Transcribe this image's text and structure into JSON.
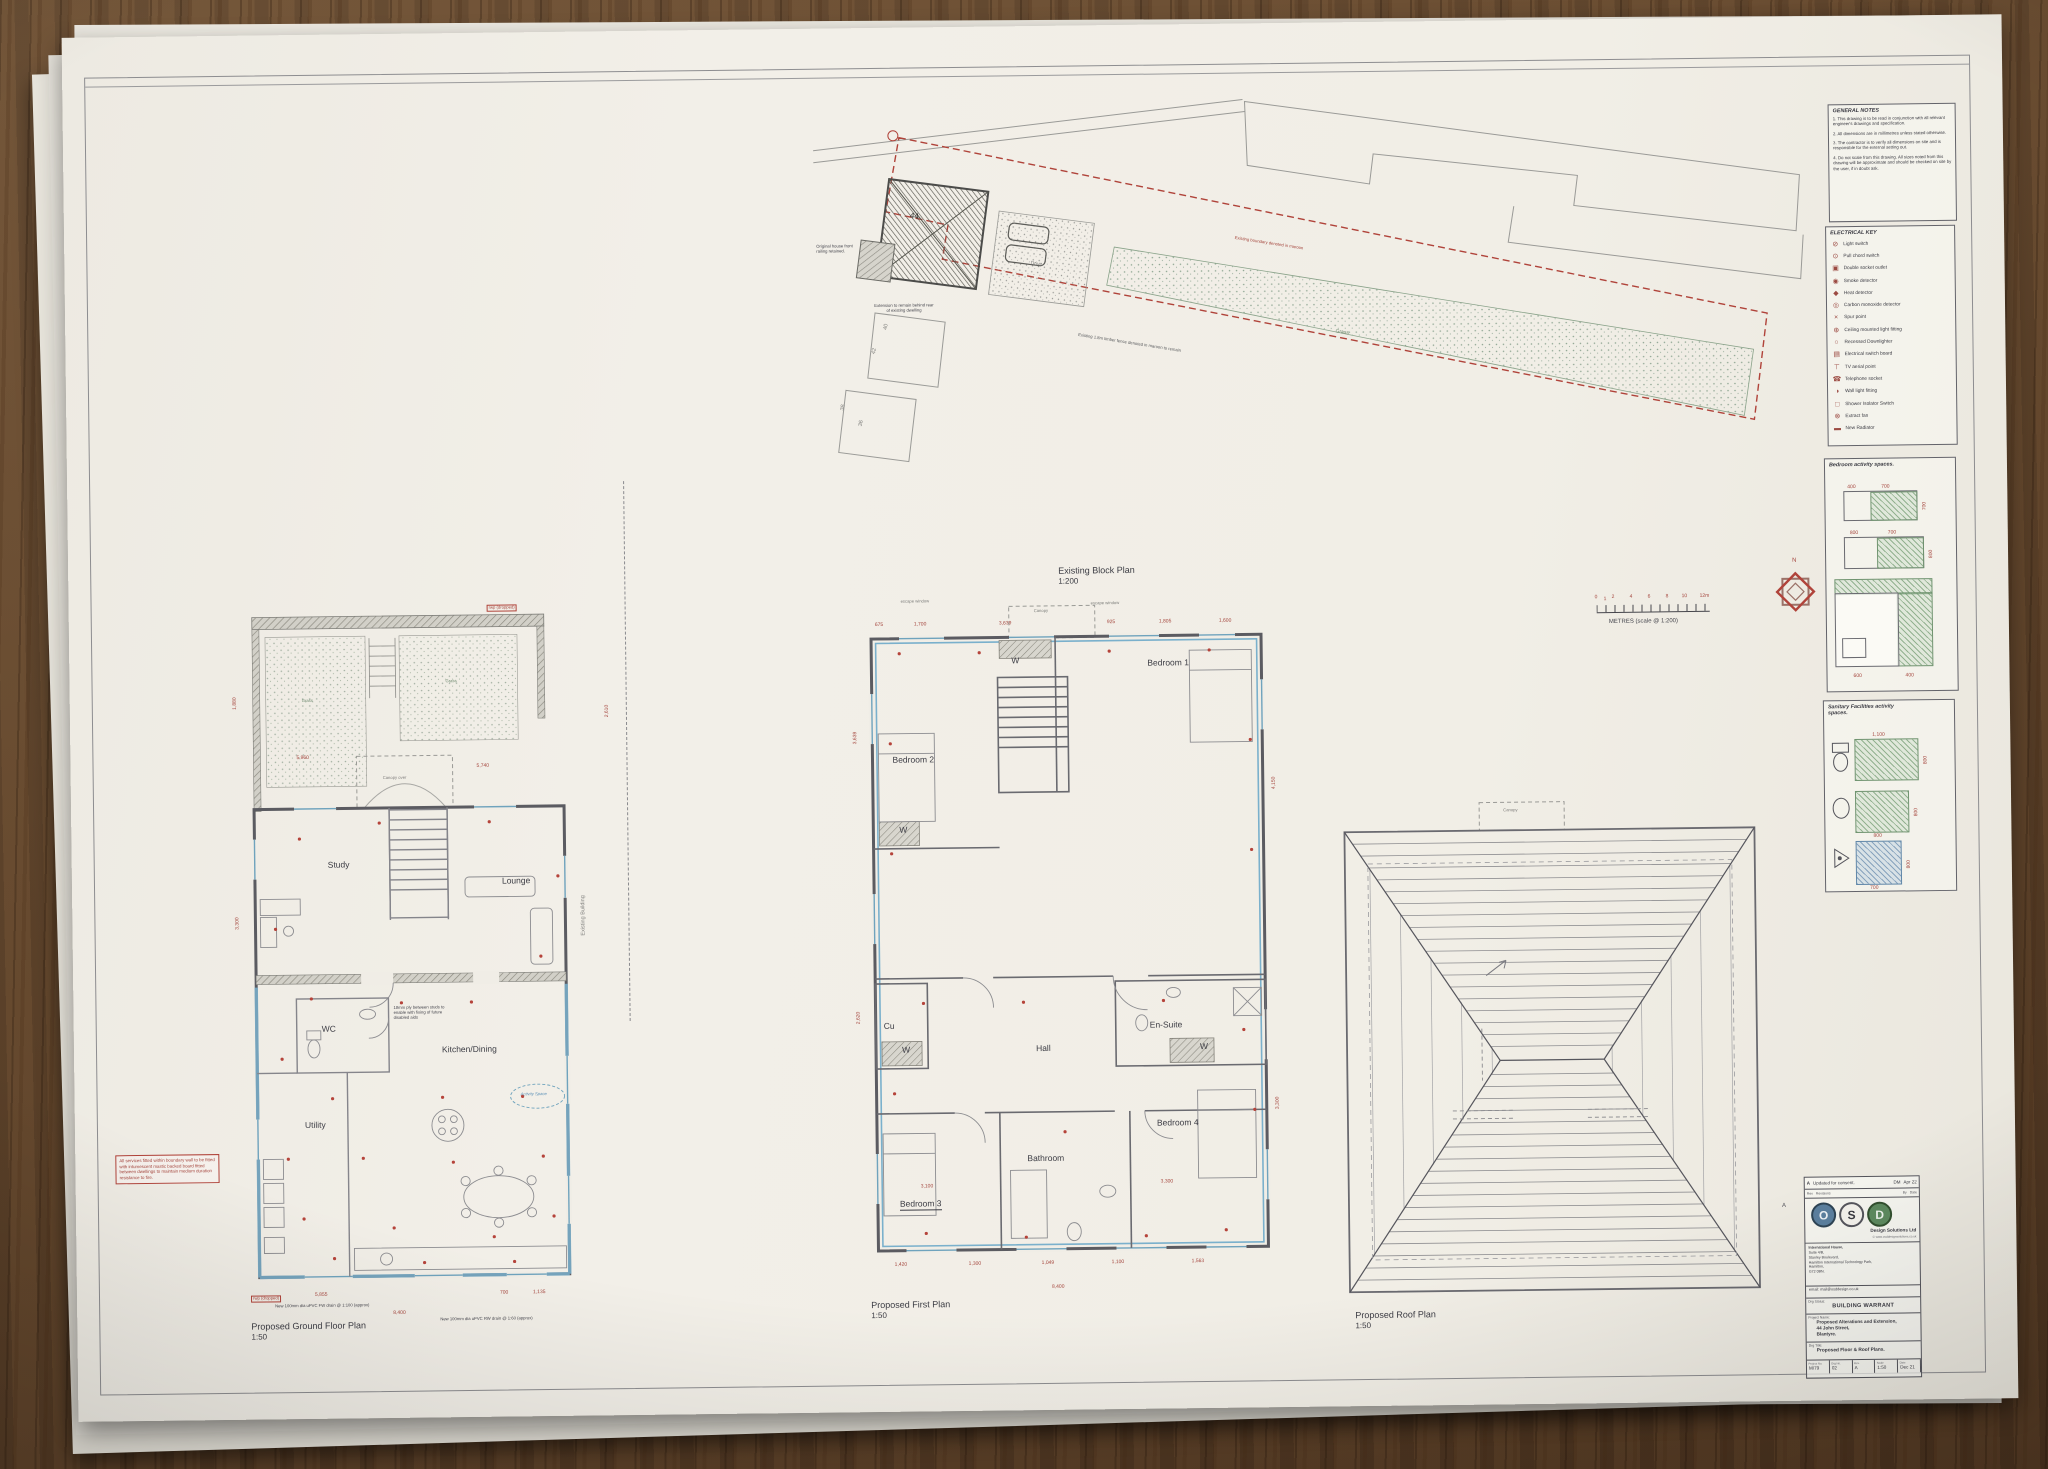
{
  "block_plan": {
    "title": "Existing Block Plan",
    "scale": "1:200",
    "house_number": "44",
    "plot_numbers": [
      "40",
      "42",
      "38",
      "36"
    ],
    "labels": {
      "drive": "Drive",
      "grass": "Grass",
      "boundary_note": "Existing boundary denoted in maroon",
      "fence_note": "Existing 1.8m timber fence denoted in maroon to remain",
      "extension_note": "Extension to remain behind rear of existing dwelling",
      "railing_note": "Original house front railing retained."
    }
  },
  "scale_bar": {
    "caption": "METRES (scale @ 1:200)",
    "north": "N",
    "tick_marks": [
      {
        "t": "0",
        "x": -2,
        "y": -11
      },
      {
        "t": "1",
        "x": 7,
        "y": -9
      },
      {
        "t": "2",
        "x": 15,
        "y": -11
      },
      {
        "t": "4",
        "x": 33,
        "y": -11
      },
      {
        "t": "6",
        "x": 51,
        "y": -11
      },
      {
        "t": "8",
        "x": 69,
        "y": -11
      },
      {
        "t": "10",
        "x": 85,
        "y": -11
      },
      {
        "t": "12m",
        "x": 103,
        "y": -11
      }
    ]
  },
  "general_notes": {
    "title": "GENERAL NOTES",
    "items": [
      "1.  This drawing is to be read in conjunction with all relevant engineer's drawings and specification.",
      "2.  All dimensions are in millimetres unless stated otherwise.",
      "3.  The contractor is to verify all dimensions on site and is responsible for the external setting out.",
      "4.  Do not scale from this drawing. All sizes noted from this drawing will be approximate and should be checked on site by the user, if in doubt ask."
    ]
  },
  "electrical_key": {
    "title": "ELECTRICAL KEY",
    "items": [
      {
        "icon": "switch",
        "glyph": "⊘",
        "label": "Light switch"
      },
      {
        "icon": "pull-chord",
        "glyph": "⊙",
        "label": "Pull chord switch"
      },
      {
        "icon": "socket",
        "glyph": "▣",
        "label": "Double socket outlet"
      },
      {
        "icon": "smoke",
        "glyph": "◉",
        "label": "Smoke detector"
      },
      {
        "icon": "heat",
        "glyph": "◆",
        "label": "Heat detector"
      },
      {
        "icon": "co",
        "glyph": "◎",
        "label": "Carbon monoxide detector"
      },
      {
        "icon": "spur",
        "glyph": "×",
        "label": "Spur point"
      },
      {
        "icon": "ceiling-light",
        "glyph": "⊕",
        "label": "Ceiling mounted light fitting"
      },
      {
        "icon": "downlight",
        "glyph": "○",
        "label": "Recessed Downlighter"
      },
      {
        "icon": "board",
        "glyph": "▤",
        "label": "Electrical switch board"
      },
      {
        "icon": "tv",
        "glyph": "⊤",
        "label": "TV aerial point"
      },
      {
        "icon": "phone",
        "glyph": "☎",
        "label": "Telephone socket"
      },
      {
        "icon": "wall-light",
        "glyph": "◑",
        "label": "Wall light fitting"
      },
      {
        "icon": "shower-switch",
        "glyph": "□",
        "label": "Shower Isolator Switch"
      },
      {
        "icon": "fan",
        "glyph": "⊗",
        "label": "Extract fan"
      },
      {
        "icon": "radiator",
        "glyph": "▬",
        "label": "New Radiator"
      }
    ]
  },
  "bedroom_spaces": {
    "title": "Bedroom activity spaces.",
    "d1": [
      "400",
      "700",
      "700"
    ],
    "d2": [
      "800",
      "700",
      "800"
    ],
    "d3": [
      "600",
      "400"
    ]
  },
  "sanitary_spaces": {
    "title": "Sanitary Facilities activity spaces.",
    "wc": [
      "1,100",
      "800"
    ],
    "basin": [
      "800",
      "800"
    ],
    "shower": [
      "800",
      "700"
    ]
  },
  "ground_floor": {
    "title": "Proposed Ground Floor Plan",
    "scale": "1:50",
    "rooms": {
      "study": "Study",
      "lounge": "Lounge",
      "wc": "WC",
      "kitchen": "Kitchen/Dining",
      "utility": "Utility"
    },
    "labels": {
      "grass_left": "Grass",
      "grass_right": "Grass",
      "canopy": "Canopy over",
      "activity": "Activity Space",
      "ply_note": "18mm ply between studs to enable with fixing of future disabled aids",
      "existing_building": "Existing Building",
      "rwp1": "rwp (dropped)",
      "rwp2": "rwp (dropped)"
    },
    "red_note": "All services fitted within boundary wall to be fitted with intumescent mastic backed board fitted between dwellings to maintain medium duration resistance to fire.",
    "drain_note_fw": "New 100mm dia uPVC FW drain @ 1:100 (approx)",
    "drain_note_rw": "New 100mm dia uPVC RW drain @ 1:60 (approx)",
    "dims": [
      {
        "t": "5,960",
        "x": 58,
        "y": 296
      },
      {
        "t": "5,740",
        "x": 238,
        "y": 306
      },
      {
        "t": "1,880",
        "x": -6,
        "y": 250,
        "r": -90
      },
      {
        "t": "3,300",
        "x": -6,
        "y": 470,
        "r": -90
      },
      {
        "t": "2,610",
        "x": 366,
        "y": 262,
        "r": -90
      },
      {
        "t": "8,400",
        "x": 148,
        "y": 852
      },
      {
        "t": "5,855",
        "x": 70,
        "y": 833
      },
      {
        "t": "700",
        "x": 255,
        "y": 833
      },
      {
        "t": "1,135",
        "x": 288,
        "y": 833
      }
    ]
  },
  "first_floor": {
    "title": "Proposed First Plan",
    "scale": "1:50",
    "rooms": {
      "bedroom1": "Bedroom 1",
      "bedroom2": "Bedroom 2",
      "bedroom3": "Bedroom 3",
      "bedroom4": "Bedroom 4",
      "bathroom": "Bathroom",
      "ensuite": "En-Suite",
      "hall": "Hall",
      "cu": "Cu",
      "w": "W"
    },
    "labels": {
      "escape1": "escape window",
      "escape2": "escape window",
      "canopy": "Canopy"
    },
    "dims": [
      {
        "t": "675",
        "x": 16,
        "y": 28
      },
      {
        "t": "1,700",
        "x": 55,
        "y": 28
      },
      {
        "t": "3,639",
        "x": 140,
        "y": 28
      },
      {
        "t": "925",
        "x": 248,
        "y": 28
      },
      {
        "t": "1,805",
        "x": 300,
        "y": 28
      },
      {
        "t": "1,600",
        "x": 360,
        "y": 28
      },
      {
        "t": "3,639",
        "x": -8,
        "y": 150,
        "r": -90
      },
      {
        "t": "2,620",
        "x": -8,
        "y": 430,
        "r": -90
      },
      {
        "t": "4,150",
        "x": 410,
        "y": 200,
        "r": -90
      },
      {
        "t": "3,300",
        "x": 410,
        "y": 520,
        "r": -90
      },
      {
        "t": "1,420",
        "x": 28,
        "y": 668
      },
      {
        "t": "1,300",
        "x": 102,
        "y": 668
      },
      {
        "t": "1,049",
        "x": 175,
        "y": 668
      },
      {
        "t": "1,100",
        "x": 245,
        "y": 668
      },
      {
        "t": "1,563",
        "x": 325,
        "y": 668
      },
      {
        "t": "8,400",
        "x": 185,
        "y": 692
      },
      {
        "t": "3,100",
        "x": 55,
        "y": 590
      },
      {
        "t": "3,300",
        "x": 295,
        "y": 588
      }
    ]
  },
  "roof_plan": {
    "title": "Proposed Roof Plan",
    "scale": "1:50",
    "labels": {
      "canopy": "Canopy"
    }
  },
  "title_block": {
    "marker": "A",
    "revision": {
      "rev": "A",
      "desc": "Updated for consent.",
      "by": "DM",
      "date": "Apr 22"
    },
    "header": {
      "rev": "Rev",
      "revisions": "Revisions",
      "by": "By",
      "date": "Date"
    },
    "logo": {
      "o": "O",
      "s": "S",
      "d": "D",
      "company": "Design Solutions Ltd",
      "url": "© www.osddesignsolutions.co.uk"
    },
    "address": [
      "International House,",
      "Suite 4/B,",
      "Stanley Boulevard,",
      "Hamilton International Technology Park,",
      "Hamilton,",
      "G72 0BN."
    ],
    "email": "email: mail@osddesign.co.uk",
    "status_label": "Drg Status:",
    "status": "BUILDING WARRANT",
    "project_label": "Project Name:",
    "project": [
      "Proposed Alterations and Extension,",
      "44 John Street,",
      "Blantyre."
    ],
    "title_label": "Drg Title:",
    "drg_title": "Proposed Floor & Roof Plans.",
    "fields": [
      {
        "label": "Project No.",
        "value": "M/79"
      },
      {
        "label": "Drg No.",
        "value": "02"
      },
      {
        "label": "Rev.",
        "value": "A"
      },
      {
        "label": "Scale",
        "value": "1:50"
      },
      {
        "label": "Date",
        "value": "Dec 21"
      }
    ]
  }
}
